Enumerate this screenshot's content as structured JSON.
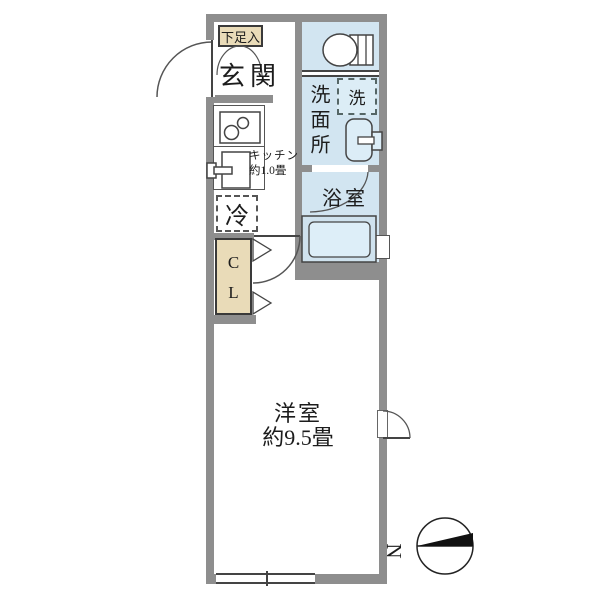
{
  "title": "1K floor plan",
  "labels": {
    "shoe_cabinet": "下足入",
    "entrance": "玄関",
    "kitchen_line1": "キッチン",
    "kitchen_line2": "約1.0畳",
    "fridge": "冷",
    "closet_line1": "C",
    "closet_line2": "L",
    "washer": "洗",
    "washroom": "洗面所",
    "bathroom": "浴室",
    "main_room": "洋室",
    "main_room_size": "約9.5畳",
    "compass_north": "N"
  },
  "rooms": [
    {
      "name": "玄関",
      "type": "entrance"
    },
    {
      "name": "下足入",
      "type": "shoe-storage"
    },
    {
      "name": "キッチン",
      "size": "約1.0畳",
      "type": "kitchen"
    },
    {
      "name": "冷",
      "type": "refrigerator-space"
    },
    {
      "name": "CL",
      "type": "closet"
    },
    {
      "name": "トイレ",
      "type": "toilet",
      "label_shown": ""
    },
    {
      "name": "洗面所",
      "type": "washroom"
    },
    {
      "name": "洗",
      "type": "washing-machine-space"
    },
    {
      "name": "浴室",
      "type": "bathroom"
    },
    {
      "name": "洋室",
      "size": "約9.5畳",
      "type": "main-room"
    }
  ],
  "compass": {
    "direction_pointer": "left",
    "letter": "N"
  },
  "colors": {
    "wall": "#8e8e8e",
    "water_area": "#d2e5f1",
    "fixture_light": "#dcedf7",
    "storage_beige": "#e9dbb8",
    "line": "#444444",
    "background": "#ffffff"
  }
}
